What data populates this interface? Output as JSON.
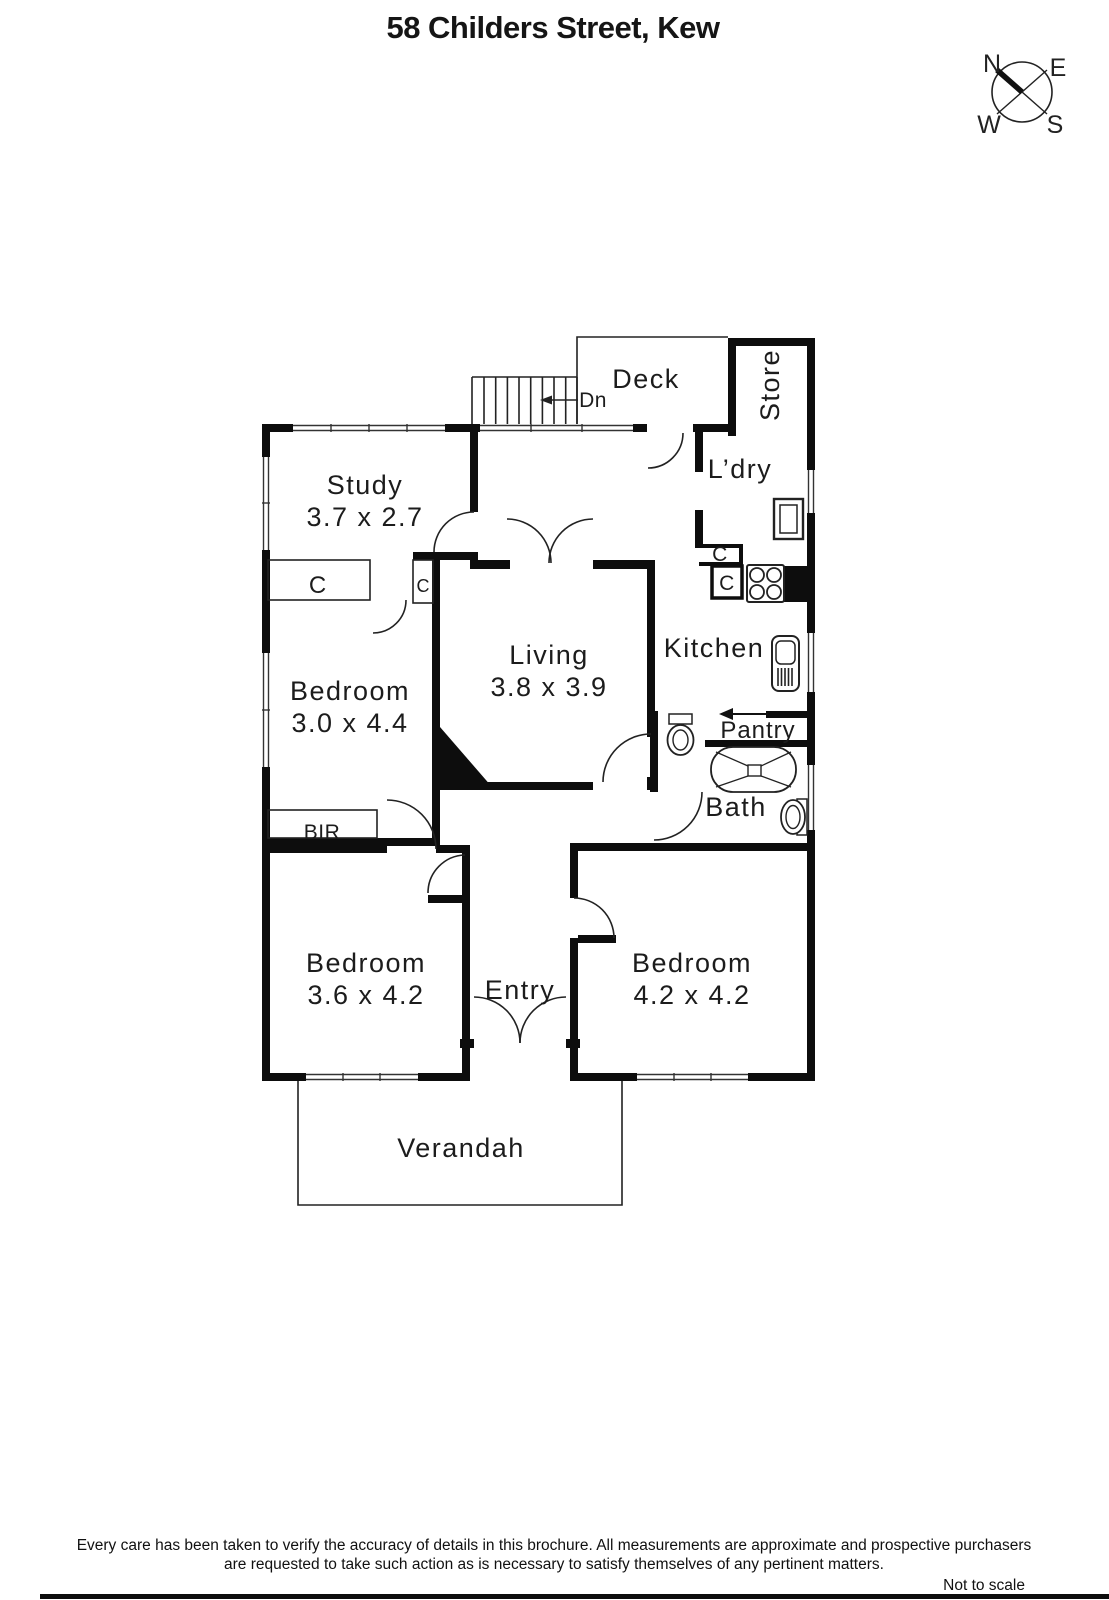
{
  "title": "58 Childers Street, Kew",
  "compass": {
    "north": "N",
    "east": "E",
    "west": "W",
    "south": "S"
  },
  "rooms": {
    "deck": {
      "name": "Deck"
    },
    "store": {
      "name": "Store"
    },
    "study": {
      "name": "Study",
      "dims": "3.7 x 2.7"
    },
    "laundry": {
      "name": "L’dry"
    },
    "living": {
      "name": "Living",
      "dims": "3.8 x 3.9"
    },
    "kitchen": {
      "name": "Kitchen"
    },
    "bedroom_nw": {
      "name": "Bedroom",
      "dims": "3.0 x 4.4"
    },
    "pantry": {
      "name": "Pantry"
    },
    "bath": {
      "name": "Bath"
    },
    "bedroom_sw": {
      "name": "Bedroom",
      "dims": "3.6 x 4.2"
    },
    "entry": {
      "name": "Entry"
    },
    "bedroom_se": {
      "name": "Bedroom",
      "dims": "4.2 x 4.2"
    },
    "verandah": {
      "name": "Verandah"
    }
  },
  "markers": {
    "stairs_down": "Dn",
    "built_in_robe": "BIR",
    "closet": "C"
  },
  "colors": {
    "walls": "#0d0d0d",
    "background": "#ffffff",
    "lines": "#222222"
  },
  "footer": {
    "disclaimer_line1": "Every care has been taken to verify the accuracy of details in this brochure.  All measurements are approximate and prospective purchasers",
    "disclaimer_line2": "are requested to take such action as is necessary to satisfy themselves of any pertinent matters.",
    "scale_note": "Not to scale"
  }
}
